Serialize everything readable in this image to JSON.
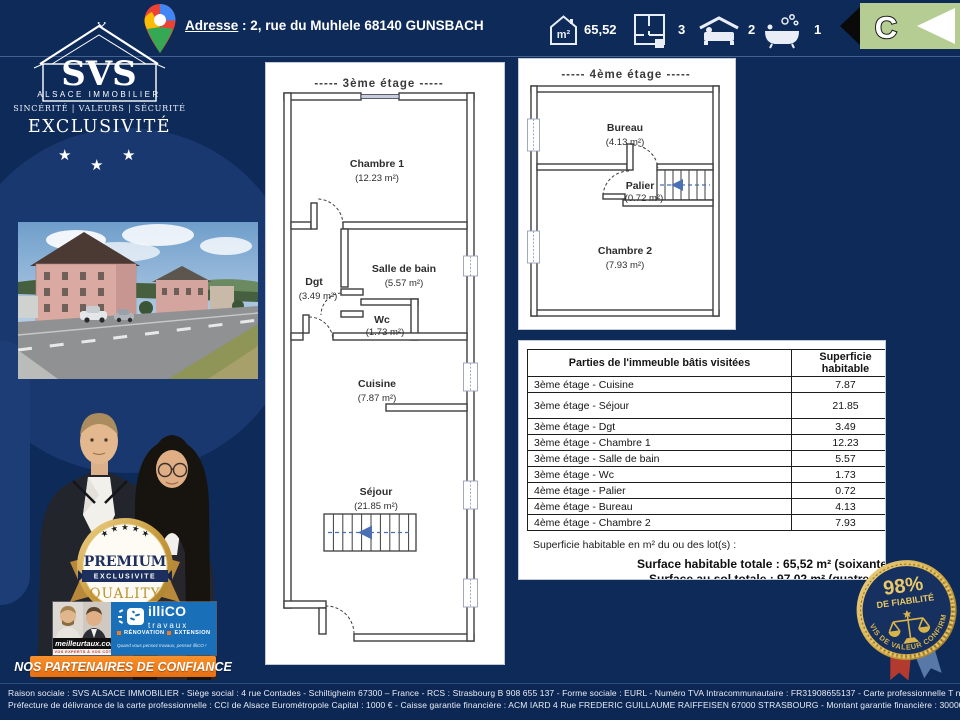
{
  "header": {
    "address_label": "Adresse",
    "address_sep": " : ",
    "address_value": "2, rue du Muhlele 68140 GUNSBACH",
    "area_unit": "m²",
    "area_value": "65,52",
    "rooms_value": "3",
    "bedrooms_value": "2",
    "bathrooms_value": "1",
    "energy_class": "C"
  },
  "logo": {
    "brand": "SVS",
    "brand_sub": "ALSACE IMMOBILIER",
    "tagline": "SINCÉRITÉ | VALEURS | SÉCURITÉ",
    "banner": "EXCLUSIVITÉ",
    "star": "★"
  },
  "plan3": {
    "title": "-----  3ème étage  -----",
    "chambre1_name": "Chambre 1",
    "chambre1_area": "(12.23 m²)",
    "dgt_name": "Dgt",
    "dgt_area": "(3.49 m²)",
    "sdb_name": "Salle de bain",
    "sdb_area": "(5.57 m²)",
    "wc_name": "Wc",
    "wc_area": "(1.73 m²)",
    "cuisine_name": "Cuisine",
    "cuisine_area": "(7.87 m²)",
    "sejour_name": "Séjour",
    "sejour_area": "(21.85 m²)"
  },
  "plan4": {
    "title": "-----  4ème étage  -----",
    "bureau_name": "Bureau",
    "bureau_area": "(4.13 m²)",
    "palier_name": "Palier",
    "palier_area": "(0.72 m²)",
    "chambre2_name": "Chambre 2",
    "chambre2_area": "(7.93 m²)"
  },
  "table": {
    "col1": "Parties de l'immeuble bâtis visitées",
    "col2": "Superficie habitable",
    "rows": [
      {
        "label": "3ème étage - Cuisine",
        "value": "7.87"
      },
      {
        "label": "3ème étage - Séjour",
        "value": "21.85",
        "tall": true
      },
      {
        "label": "3ème étage - Dgt",
        "value": "3.49"
      },
      {
        "label": "3ème étage - Chambre 1",
        "value": "12.23"
      },
      {
        "label": "3ème étage - Salle de bain",
        "value": "5.57"
      },
      {
        "label": "3ème étage - Wc",
        "value": "1.73"
      },
      {
        "label": "4ème étage - Palier",
        "value": "0.72"
      },
      {
        "label": "4ème étage - Bureau",
        "value": "4.13"
      },
      {
        "label": "4ème étage - Chambre 2",
        "value": "7.93"
      }
    ],
    "note": "Superficie habitable en m² du ou des lot(s) :",
    "total_habitable": "Surface habitable totale : 65,52 m² (soixante-ci",
    "total_sol": "Surface au sol totale : 97,02 m² (quatre-vingt"
  },
  "premium_badge": {
    "stars": "★ ★ ★ ★ ★",
    "premium": "PREMIUM",
    "exclusivite": "EXCLUSIVITE",
    "quality": "QUALITY",
    "guaranteed": "GUARANTEED"
  },
  "partners": {
    "meilleurtaux": "meilleurtaux.com",
    "meilleurtaux_sub": "VOS EXPERTS À VOS CÔTÉS",
    "illico": "illiCO",
    "illico_sub": "travaux",
    "renovation": "RÉNOVATION",
    "extension": "EXTENSION",
    "illico_tagline": "Quand vous pensez travaux, pensez illiCO !",
    "banner": "NOS PARTENAIRES DE CONFIANCE"
  },
  "badge98": {
    "percent": "98%",
    "label": "DE FIABILITÉ",
    "arc": "AVIS DE VALEUR CONFIRMÉ"
  },
  "footer": {
    "line1": "Raison sociale : SVS ALSACE IMMOBILIER - Siège social : 4 rue Contades - Schiltigheim 67300 – France - RCS : Strasbourg B 908 655 137 - Forme sociale : EURL - Numéro TVA Intracommunautaire : FR31908655137 - Carte professionnelle T n° CPI67012022000000004",
    "line2": "Préfecture  de délivrance de la carte professionnelle  : CCI de Alsace Eurométropole    Capital : 1000 € -  Caisse garantie  financière  : ACM IARD 4 Rue FREDERIC  GUILLAUME  RAIFFEISEN 67000  STRASBOURG  -  Montant  garantie  financière  : 30000 €"
  },
  "colors": {
    "page_navy": "#0e2a59",
    "gold": "#c9a23c",
    "orange": "#f47a20",
    "energy_green": "#b5cc92",
    "illico_blue": "#1a70b8",
    "stair_arrow_blue": "#4a6fb5"
  }
}
